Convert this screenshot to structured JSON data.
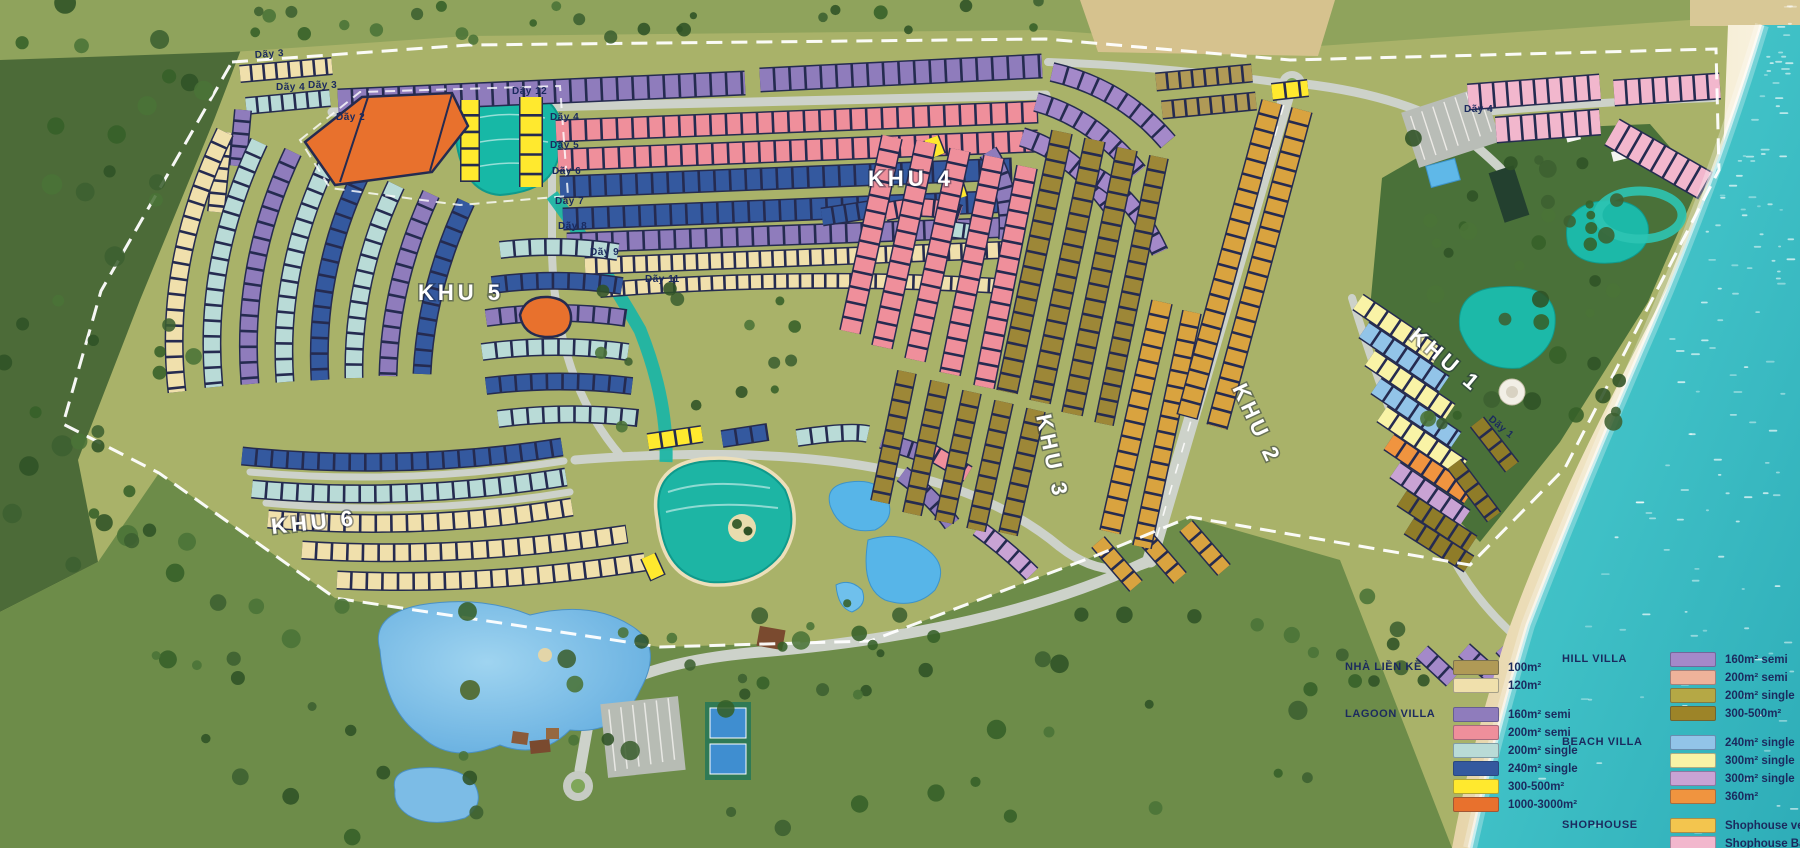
{
  "map": {
    "zones": [
      {
        "id": "khu-1",
        "label": "KHU 1",
        "x": 1408,
        "y": 338,
        "rot": 40
      },
      {
        "id": "khu-2",
        "label": "KHU 2",
        "x": 1232,
        "y": 388,
        "rot": 65
      },
      {
        "id": "khu-3",
        "label": "KHU 3",
        "x": 1036,
        "y": 416,
        "rot": 78
      },
      {
        "id": "khu-4",
        "label": "KHU 4",
        "x": 868,
        "y": 186,
        "rot": 0
      },
      {
        "id": "khu-5",
        "label": "KHU 5",
        "x": 418,
        "y": 300,
        "rot": 0
      },
      {
        "id": "khu-6",
        "label": "KHU 6",
        "x": 272,
        "y": 534,
        "rot": -6
      }
    ],
    "row_labels": [
      {
        "label": "Dãy 3",
        "x": 255,
        "y": 58,
        "rot": -4
      },
      {
        "label": "Dãy 4",
        "x": 276,
        "y": 90,
        "rot": 0
      },
      {
        "label": "Dãy 3",
        "x": 308,
        "y": 88,
        "rot": 0
      },
      {
        "label": "Dãy 2",
        "x": 336,
        "y": 120,
        "rot": 0
      },
      {
        "label": "Dãy 12",
        "x": 512,
        "y": 94,
        "rot": 0
      },
      {
        "label": "Dãy 4",
        "x": 550,
        "y": 120,
        "rot": 0
      },
      {
        "label": "Dãy 5",
        "x": 550,
        "y": 148,
        "rot": 0
      },
      {
        "label": "Dãy 6",
        "x": 552,
        "y": 174,
        "rot": 0
      },
      {
        "label": "Dãy 7",
        "x": 555,
        "y": 204,
        "rot": 0
      },
      {
        "label": "Dãy 8",
        "x": 558,
        "y": 229,
        "rot": 0
      },
      {
        "label": "Dãy 9",
        "x": 590,
        "y": 255,
        "rot": 0
      },
      {
        "label": "Dãy 11",
        "x": 645,
        "y": 282,
        "rot": 0
      },
      {
        "label": "Dãy 4",
        "x": 1464,
        "y": 112,
        "rot": 0
      },
      {
        "label": "Dãy 1",
        "x": 1488,
        "y": 420,
        "rot": 40
      }
    ]
  },
  "legend": {
    "columns": {
      "col1": [
        "NHÀ LIỀN KỀ",
        "LAGOON VILLA"
      ],
      "col2": [
        "HILL VILLA",
        "BEACH VILLA",
        "SHOPHOUSE"
      ]
    },
    "sections": [
      {
        "title": "NHÀ LIỀN KỀ",
        "col": 1,
        "items": [
          {
            "color": "#b09a56",
            "label": "100m²"
          },
          {
            "color": "#f0e0ac",
            "label": "120m²"
          }
        ]
      },
      {
        "title": "LAGOON VILLA",
        "col": 1,
        "items": [
          {
            "color": "#8f7cbc",
            "label": "160m² semi"
          },
          {
            "color": "#ef8f9b",
            "label": "200m² semi"
          },
          {
            "color": "#b9dbd7",
            "label": "200m² single"
          },
          {
            "color": "#34599f",
            "label": "240m² single"
          },
          {
            "color": "#ffe92e",
            "label": "300-500m²"
          },
          {
            "color": "#e8712d",
            "label": "1000-3000m²"
          }
        ]
      },
      {
        "title": "HILL VILLA",
        "col": 2,
        "items": [
          {
            "color": "#a489c9",
            "label": "160m² semi"
          },
          {
            "color": "#efb29a",
            "label": "200m² semi"
          },
          {
            "color": "#b5a845",
            "label": "200m² single"
          },
          {
            "color": "#9d8428",
            "label": "300-500m²"
          }
        ]
      },
      {
        "title": "BEACH VILLA",
        "col": 2,
        "items": [
          {
            "color": "#92c4e8",
            "label": "240m² single"
          },
          {
            "color": "#f9f3a6",
            "label": "300m² single"
          },
          {
            "color": "#c9a3d4",
            "label": "300m² single"
          },
          {
            "color": "#f0943f",
            "label": "360m²"
          }
        ]
      },
      {
        "title": "SHOPHOUSE",
        "col": 2,
        "items": [
          {
            "color": "#f3c54e",
            "label": "Shophouse ven biển"
          },
          {
            "color": "#f2b7cd",
            "label": "Shophouse Babylon"
          }
        ]
      }
    ]
  },
  "colors": {
    "ocean": "#3fc0c6",
    "sand": "#eedfbc",
    "grass": "#a9b269",
    "forest": "#47663a",
    "lagoon": "#17b8a6",
    "pool": "#57b5e8",
    "road": "#cdd2ca",
    "boundary": "#ffffff",
    "label_navy": "#1b2a5e"
  }
}
